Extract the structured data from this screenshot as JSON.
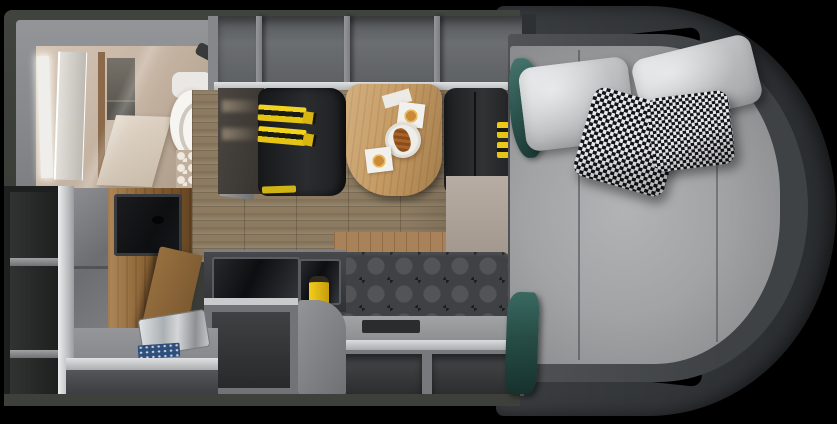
{
  "meta": {
    "label": "Top-down cutaway floor plan render of a camper van interior on a black background"
  },
  "colors": {
    "background": "#000000",
    "shell": "#34373a",
    "body_wall": "#3c3f39",
    "floor_wood": "#8c7b61",
    "cabinet_gray": "#717376",
    "seat_black": "#2a2c2f",
    "seatbelt_yellow": "#f2d41f",
    "table_wood": "#c49a63",
    "mattress_gray": "#a2a3a5",
    "pillow_light": "#c2c3c5",
    "houndstooth_dark": "#141418",
    "accent_teal": "#2c524c",
    "bathroom_beige": "#c2b09e",
    "sofa_gray": "#3f4144",
    "tv_black": "#0e0f11",
    "wood_cabinet": "#8a6234",
    "sink_steel": "#aab0b4",
    "mat_blue": "#2e4e7c",
    "cooktop": "#0d0e10"
  },
  "regions": {
    "floorplan": {
      "label": "Camper van floor plan, top view"
    },
    "cab_bed": {
      "label": "Rounded cab section with large bed, two light pillows and two houndstooth pillows"
    },
    "bathroom": {
      "label": "Bathroom with lighted mirror, shower, toilet and hex tile floor"
    },
    "overhead_shelves": {
      "label": "Open overhead storage shelves"
    },
    "dinette": {
      "label": "Dinette with two belted bench seats and wood pedestal table"
    },
    "table_setting": {
      "label": "Table set with two coffees and plate with pastry"
    },
    "kitchen": {
      "label": "Kitchen block with covered cooktop, sink and yellow kettle"
    },
    "wardrobe": {
      "label": "Wardrobe column with TV and open wood door"
    },
    "sofa": {
      "label": "Tufted bench sofa with under-seat storage cubbies"
    },
    "shelving": {
      "label": "Open shelving column on rear wall"
    },
    "bed_textiles": {
      "label": "Teal blanket and towel draped at bed edge"
    }
  }
}
